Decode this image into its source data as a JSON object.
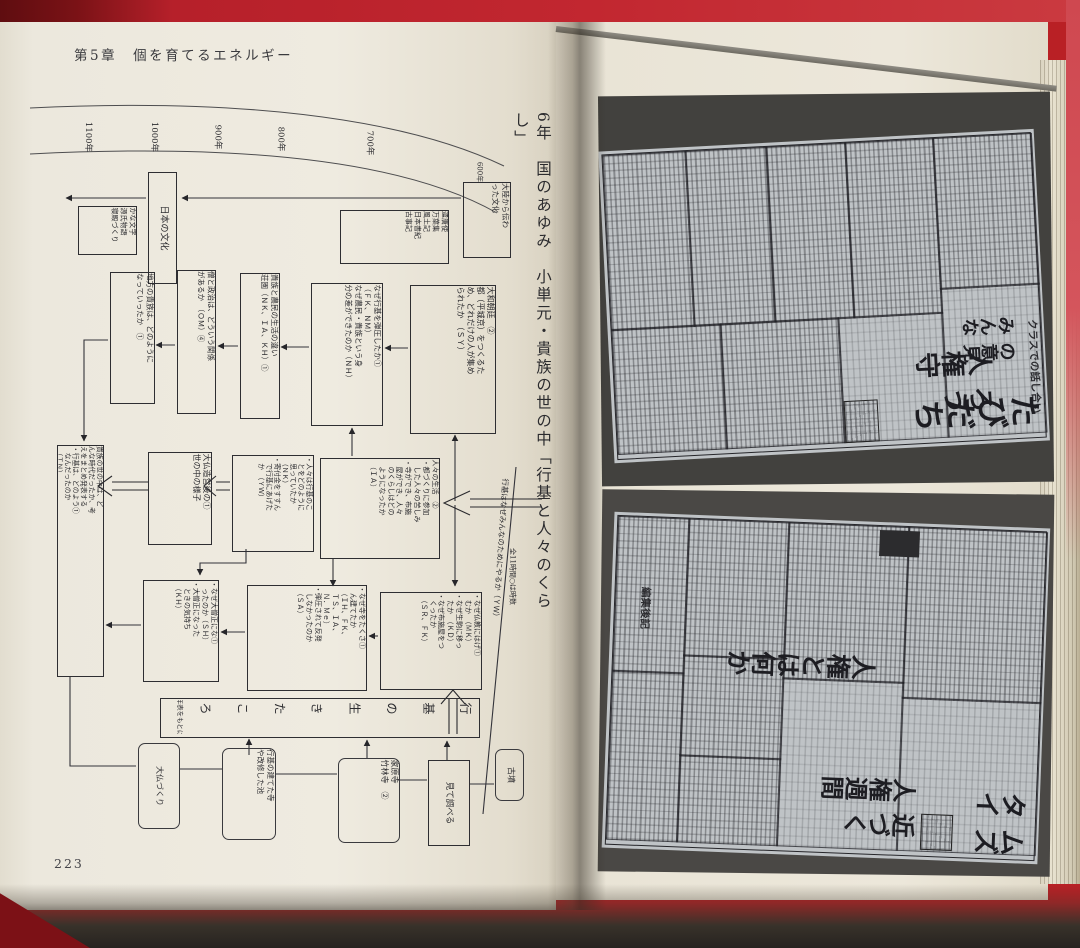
{
  "colors": {
    "table_red": "#b92025",
    "dark_red_corner": "#7c1116",
    "page_cream": "#ece8dd",
    "photo_backdrop_grey": "#454440",
    "newspaper_grey": "#c0c4c7",
    "ink": "#2c2c30"
  },
  "book": {
    "left_page": {
      "chapter_header": "第5章　個を育てるエネルギー",
      "page_number": "223",
      "timeline_years": [
        "1100年",
        "1000年",
        "900年",
        "800年",
        "700年",
        "600年"
      ],
      "unit_title": "6年　国のあゆみ　小単元・貴族の世の中「行基と人々のくらし」",
      "hours_note": "全11時間○は時数",
      "diagonal_caption": "行基はなぜみんなのためにやるか（ＹＷ）",
      "flowchart_boxes": {
        "denrai": "大陸から伝わ\nった文化",
        "nihon_bunka": "日本の文化",
        "kana": "かな文字\n源氏物語\n寝殿づくり",
        "kentoshi": "遣唐使\n万葉集\n風土記\n日本書紀\n古事記",
        "yamato": "大和朝廷　②\n都（平城京）をつくるた\nめ、どれだけの人が集め\nられたか　（ＳＹ）",
        "danatsu": "なぜ行基を弾圧したか①\n（ＦＫ、ＮＭ）\nなぜ農民・貴族という身\n分の差ができたのか（ＮＨ）",
        "seikatsu": "貴族と農民の生活の違い\n荘園（ＮＫ、ＩＡ、ＫＨ）①",
        "so_seiji": "僧と政治は、どういう関係\nがあるか　（ＯＭ）④",
        "chiho": "地方の貴族は、どのように\nなっていったか　①",
        "hitobito": "人々の生活　②\n・都づくりに参加\n　した人々の苦しみ\n・寺ができ、布施\n　屋ができ、人々\n　のくらしはどの\n　ようになったか\n　（ＩＡ）",
        "omoi": "・人々は行基のこ\n　とをどのように\n　思っていたか\n　（ＮＫ）\n・寄付金をすすん\n　で行基にあげた\n　か　（ＹＷ）",
        "daibutsu_zoei": "大仏造営後の①\n世の中の様子",
        "matome": "貴族の世の中は、ど\nんな時代だったか、考\nえをまとめ発表する\n・行基は、どのよう①\n　なんだったのか\n　（ＴＮ）",
        "naze_bukkyo": "・なぜ仏教にはげ①\n　むか　（ＭＫ）\n・なぜ生駒に移っ\n　たか　（ＫＤ）\n・なぜ布施屋をつ\n　くったか\n　（ＳＲ、ＦＫ）",
        "naze_tera": "・なぜ寺をたくさ①\n　ん建てたか\n　（ＩＨ、ＦＫ、\n　ＴＳ、ＩＡ、\n　Ｎ．Ｍｅ）\n・弾圧されて反発\n　しなかったのか\n　（ＳＡ）",
        "daisojo": "・なぜ大僧正にな①\n　ったのか（ＳＨ）\n・大僧正になった\n　ときの気持ち\n　（ＫＨ）",
        "nenpyo_bar": "行基の生きたころ",
        "nenpyo_note": "（年表をもとに）",
        "wavy_daibutsu": "大仏づくり",
        "wavy_teraike": "行基の建てた寺\nや改修した池",
        "wavy_iehara": "家原寺\n竹林寺　②",
        "mite_shiraberu": "見て調べる",
        "wavy_kofun": "古墳"
      }
    },
    "right_page": {
      "photo_top": {
        "headline_small": "みんなの意見",
        "headline_large": "人権守ろう",
        "subhead": "クラスでの話し合い",
        "masthead": "たびだち"
      },
      "photo_bottom": {
        "headline_what": "人権とは何か",
        "headline_week": "人権週間近づく",
        "masthead": "タイムズ",
        "section_label": "編集後記"
      }
    }
  }
}
